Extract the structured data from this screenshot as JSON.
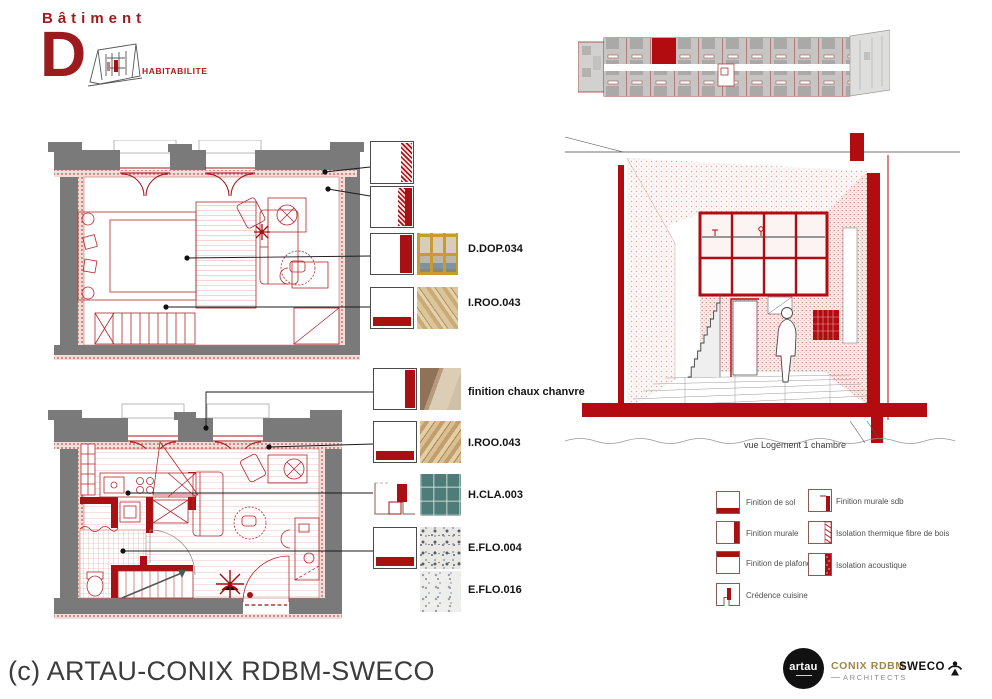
{
  "header": {
    "title": "Bâtiment",
    "letter": "D",
    "subtitle": "HABITABILITE"
  },
  "materials": {
    "items": [
      {
        "label": "D.DOP.034"
      },
      {
        "label": "I.ROO.043"
      },
      {
        "label": "finition chaux chanvre"
      },
      {
        "label": "I.ROO.043"
      },
      {
        "label": "H.CLA.003"
      },
      {
        "label": "E.FLO.004"
      },
      {
        "label": "E.FLO.016"
      }
    ]
  },
  "perspective": {
    "caption": "vue Logement 1 chambre"
  },
  "legend": {
    "items": [
      {
        "label": "Finition de sol"
      },
      {
        "label": "Finition murale"
      },
      {
        "label": "Finition de plafond"
      },
      {
        "label": "Crédence cuisine"
      },
      {
        "label": "Finition murale sdb"
      },
      {
        "label": "Isolation thermique fibre de bois"
      },
      {
        "label": "Isolation acoustique"
      }
    ]
  },
  "footer": {
    "copyright": "(c) ARTAU-CONIX RDBM-SWECO"
  },
  "logos": {
    "artau": "artau",
    "conix_line1": "CONIX RDBM",
    "conix_line2": "ARCHITECTS",
    "sweco": "SWECO"
  },
  "colors": {
    "accent_red": "#a81014",
    "title_red": "#9c1b1f",
    "wall_gray": "#7a7a7a",
    "hatch_pink": "#d99a93",
    "tile_teal": "#4e7d79",
    "conix_gold": "#a08648"
  }
}
